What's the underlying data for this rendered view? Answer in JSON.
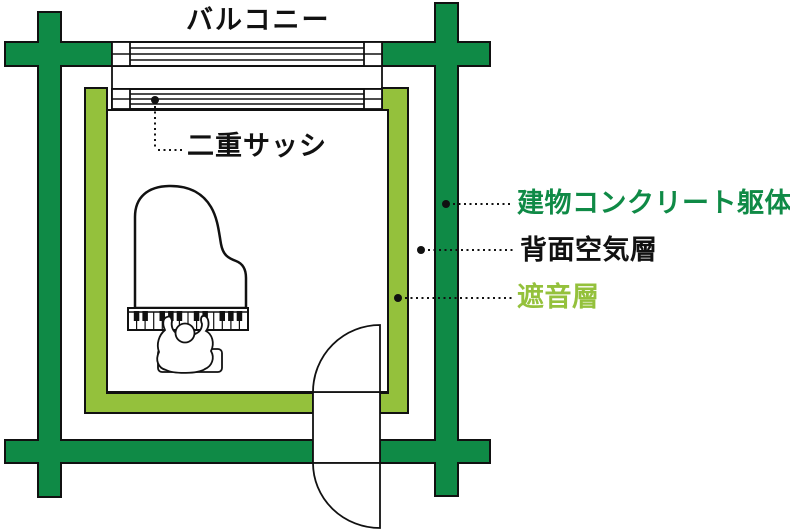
{
  "labels": {
    "balcony": "バルコニー",
    "double_sash": "二重サッシ",
    "concrete_frame": "建物コンクリート躯体",
    "rear_air_layer": "背面空気層",
    "sound_insulation_layer": "遮音層"
  },
  "colors": {
    "concrete_green": "#0f8a46",
    "insulation_green": "#94c13c",
    "outline_black": "#111111",
    "background": "#ffffff"
  }
}
